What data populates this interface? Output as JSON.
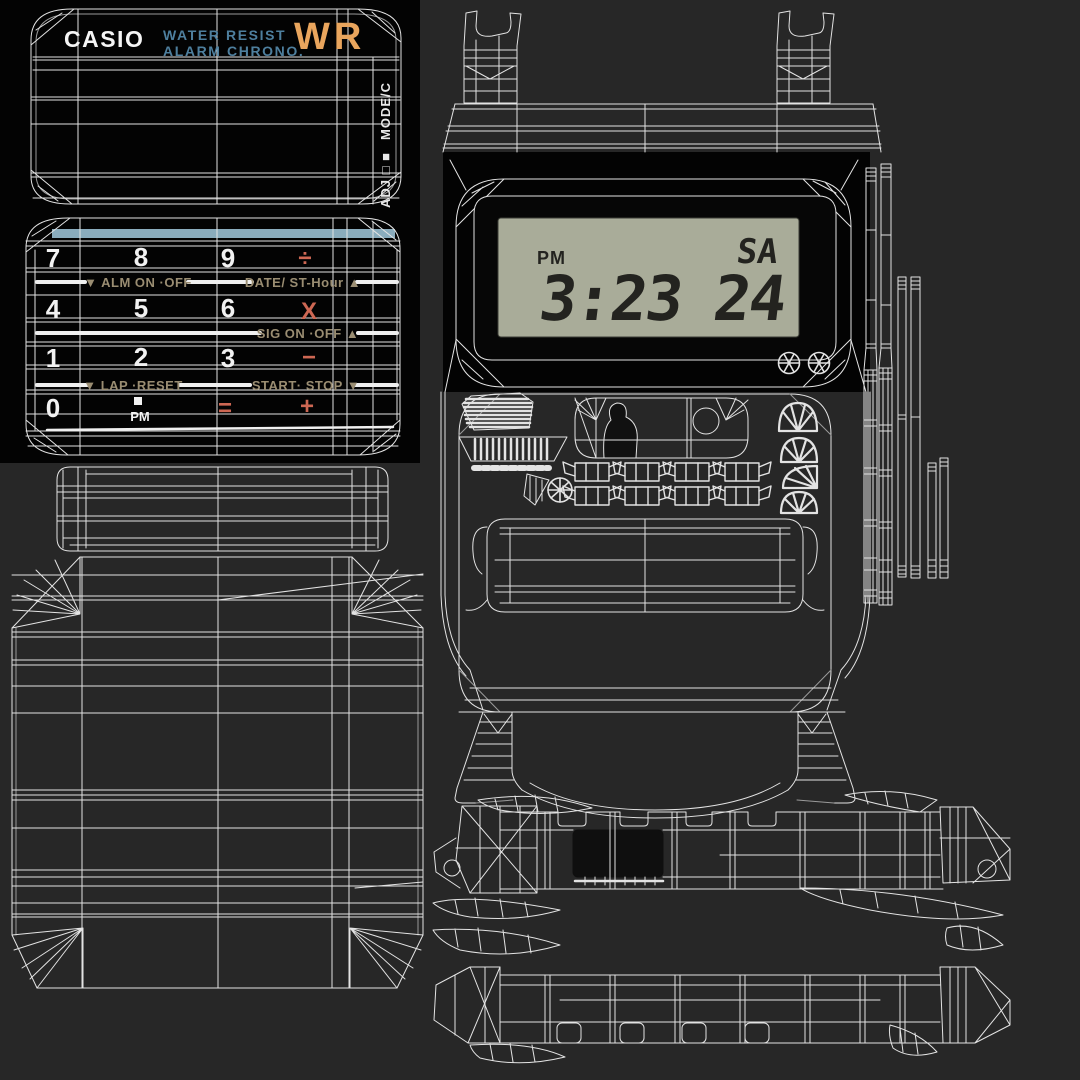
{
  "scene": {
    "description": "Casio calculator watch 3D model wireframe UV texture sheet"
  },
  "colors": {
    "background": "#272727",
    "panel_black": "#030303",
    "wireframe": "#e3e3e3",
    "lcd_background": "#a9ac99",
    "lcd_ink": "#23231f",
    "brand_white": "#f5f5f5",
    "label_blue": "#4e7f9e",
    "logo_orange": "#e9a55d",
    "label_tan": "#9a8d72",
    "operator_salmon": "#cd6753",
    "accent_bar_blue": "#8aacbd"
  },
  "cover_panel": {
    "brand": "CASIO",
    "feature_line1": "WATER RESIST",
    "feature_line2": "ALARM CHRONO.",
    "logo": "WR",
    "side_mode_label": "MODE/C",
    "side_adj_label": "ADJ □ ■"
  },
  "keypad_panel": {
    "digit_7": "7",
    "digit_8": "8",
    "digit_9": "9",
    "op_divide": "÷",
    "label_alarm": "▼ ALM ON ·OFF",
    "label_date": "DATE/ ST-Hour ▲",
    "digit_4": "4",
    "digit_5": "5",
    "digit_6": "6",
    "op_multiply": "X",
    "label_signal": "SIG ON ·OFF ▲",
    "digit_1": "1",
    "digit_2": "2",
    "digit_3": "3",
    "op_minus": "−",
    "label_lap": "▼ LAP ·RESET",
    "label_start": "START· STOP ▼",
    "digit_0": "0",
    "pm_indicator": "PM",
    "op_equals": "=",
    "op_plus": "+"
  },
  "lcd_display": {
    "ampm": "PM",
    "weekday": "SA",
    "time": "3:23",
    "seconds": "24"
  }
}
